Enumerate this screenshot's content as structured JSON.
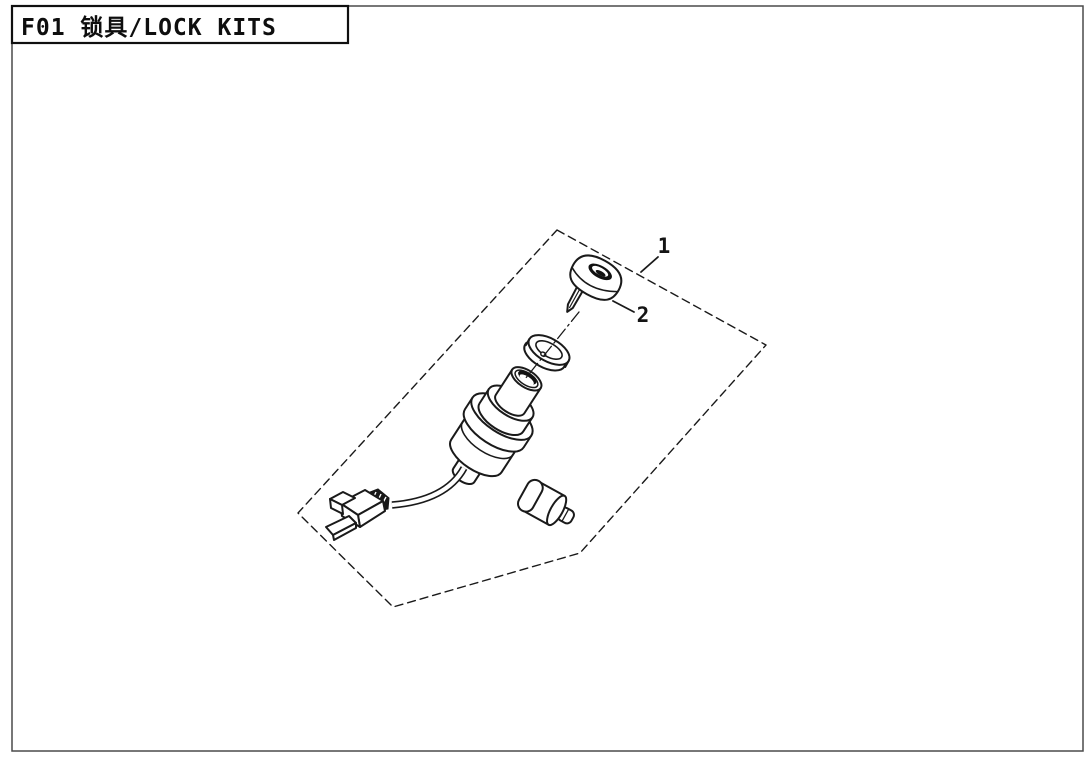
{
  "page": {
    "title": "F01 锁具/LOCK KITS",
    "background_color": "#ffffff",
    "line_color": "#1a1a1a"
  },
  "diagram": {
    "boundary_style": "dashed-polygon",
    "callouts": [
      {
        "label": "1"
      },
      {
        "label": "2"
      }
    ],
    "part_icons": [
      {
        "name": "key-cap-icon"
      },
      {
        "name": "dust-ring-icon"
      },
      {
        "name": "ignition-switch-body-icon"
      },
      {
        "name": "wire-harness-icon"
      },
      {
        "name": "wire-connector-icon"
      },
      {
        "name": "lock-barrel-icon"
      }
    ]
  }
}
